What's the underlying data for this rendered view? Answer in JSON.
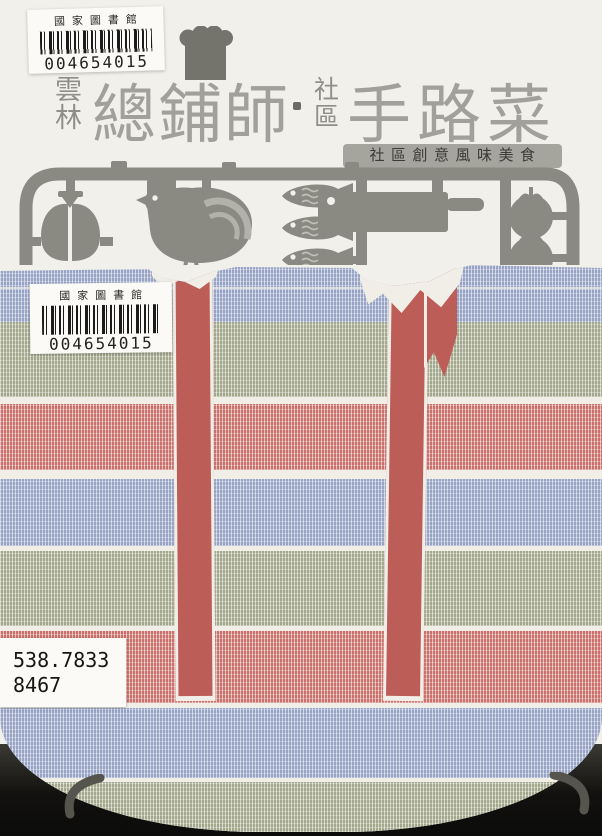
{
  "cover": {
    "series_region": [
      "雲",
      "林"
    ],
    "title_main_left": "總鋪師",
    "separator_dot": "·",
    "community_label": [
      "社",
      "區"
    ],
    "title_main_right": "手路菜",
    "subtitle_banner": "社區創意風味美食"
  },
  "library": {
    "top_sticker": {
      "library_name": "國家圖書館",
      "barcode_number": "004654015"
    },
    "bag_sticker": {
      "library_name": "國家圖書館",
      "barcode_number": "004654015"
    },
    "call_number_sticker": {
      "classification": "538.7833",
      "author_number": "8467"
    }
  },
  "icons": {
    "chef_hat": "chef-hat-icon",
    "pork_leg": "pork-leg-icon",
    "rooster": "rooster-icon",
    "fish": "fish-icon",
    "cleaver": "cleaver-icon",
    "tomato": "tomato-icon",
    "wok_handle_left": "wok-handle-left-icon",
    "wok_handle_right": "wok-handle-right-icon"
  },
  "colors": {
    "paper": "#f2f0ea",
    "sprue-gray": "#8a8a83",
    "title-gray": "#a1a099",
    "band-gray": "#a5a59d",
    "band-text": "#3b3b37",
    "stripe-blue": "#97a3c5",
    "stripe-olive": "#a3a78c",
    "stripe-red": "#c9706a",
    "strap-red": "#bd5d58",
    "seam-white": "#f0eee7",
    "scan-dark": "#181816",
    "handle-gray": "#55544d",
    "barcode-ink": "#1b1b1b"
  }
}
